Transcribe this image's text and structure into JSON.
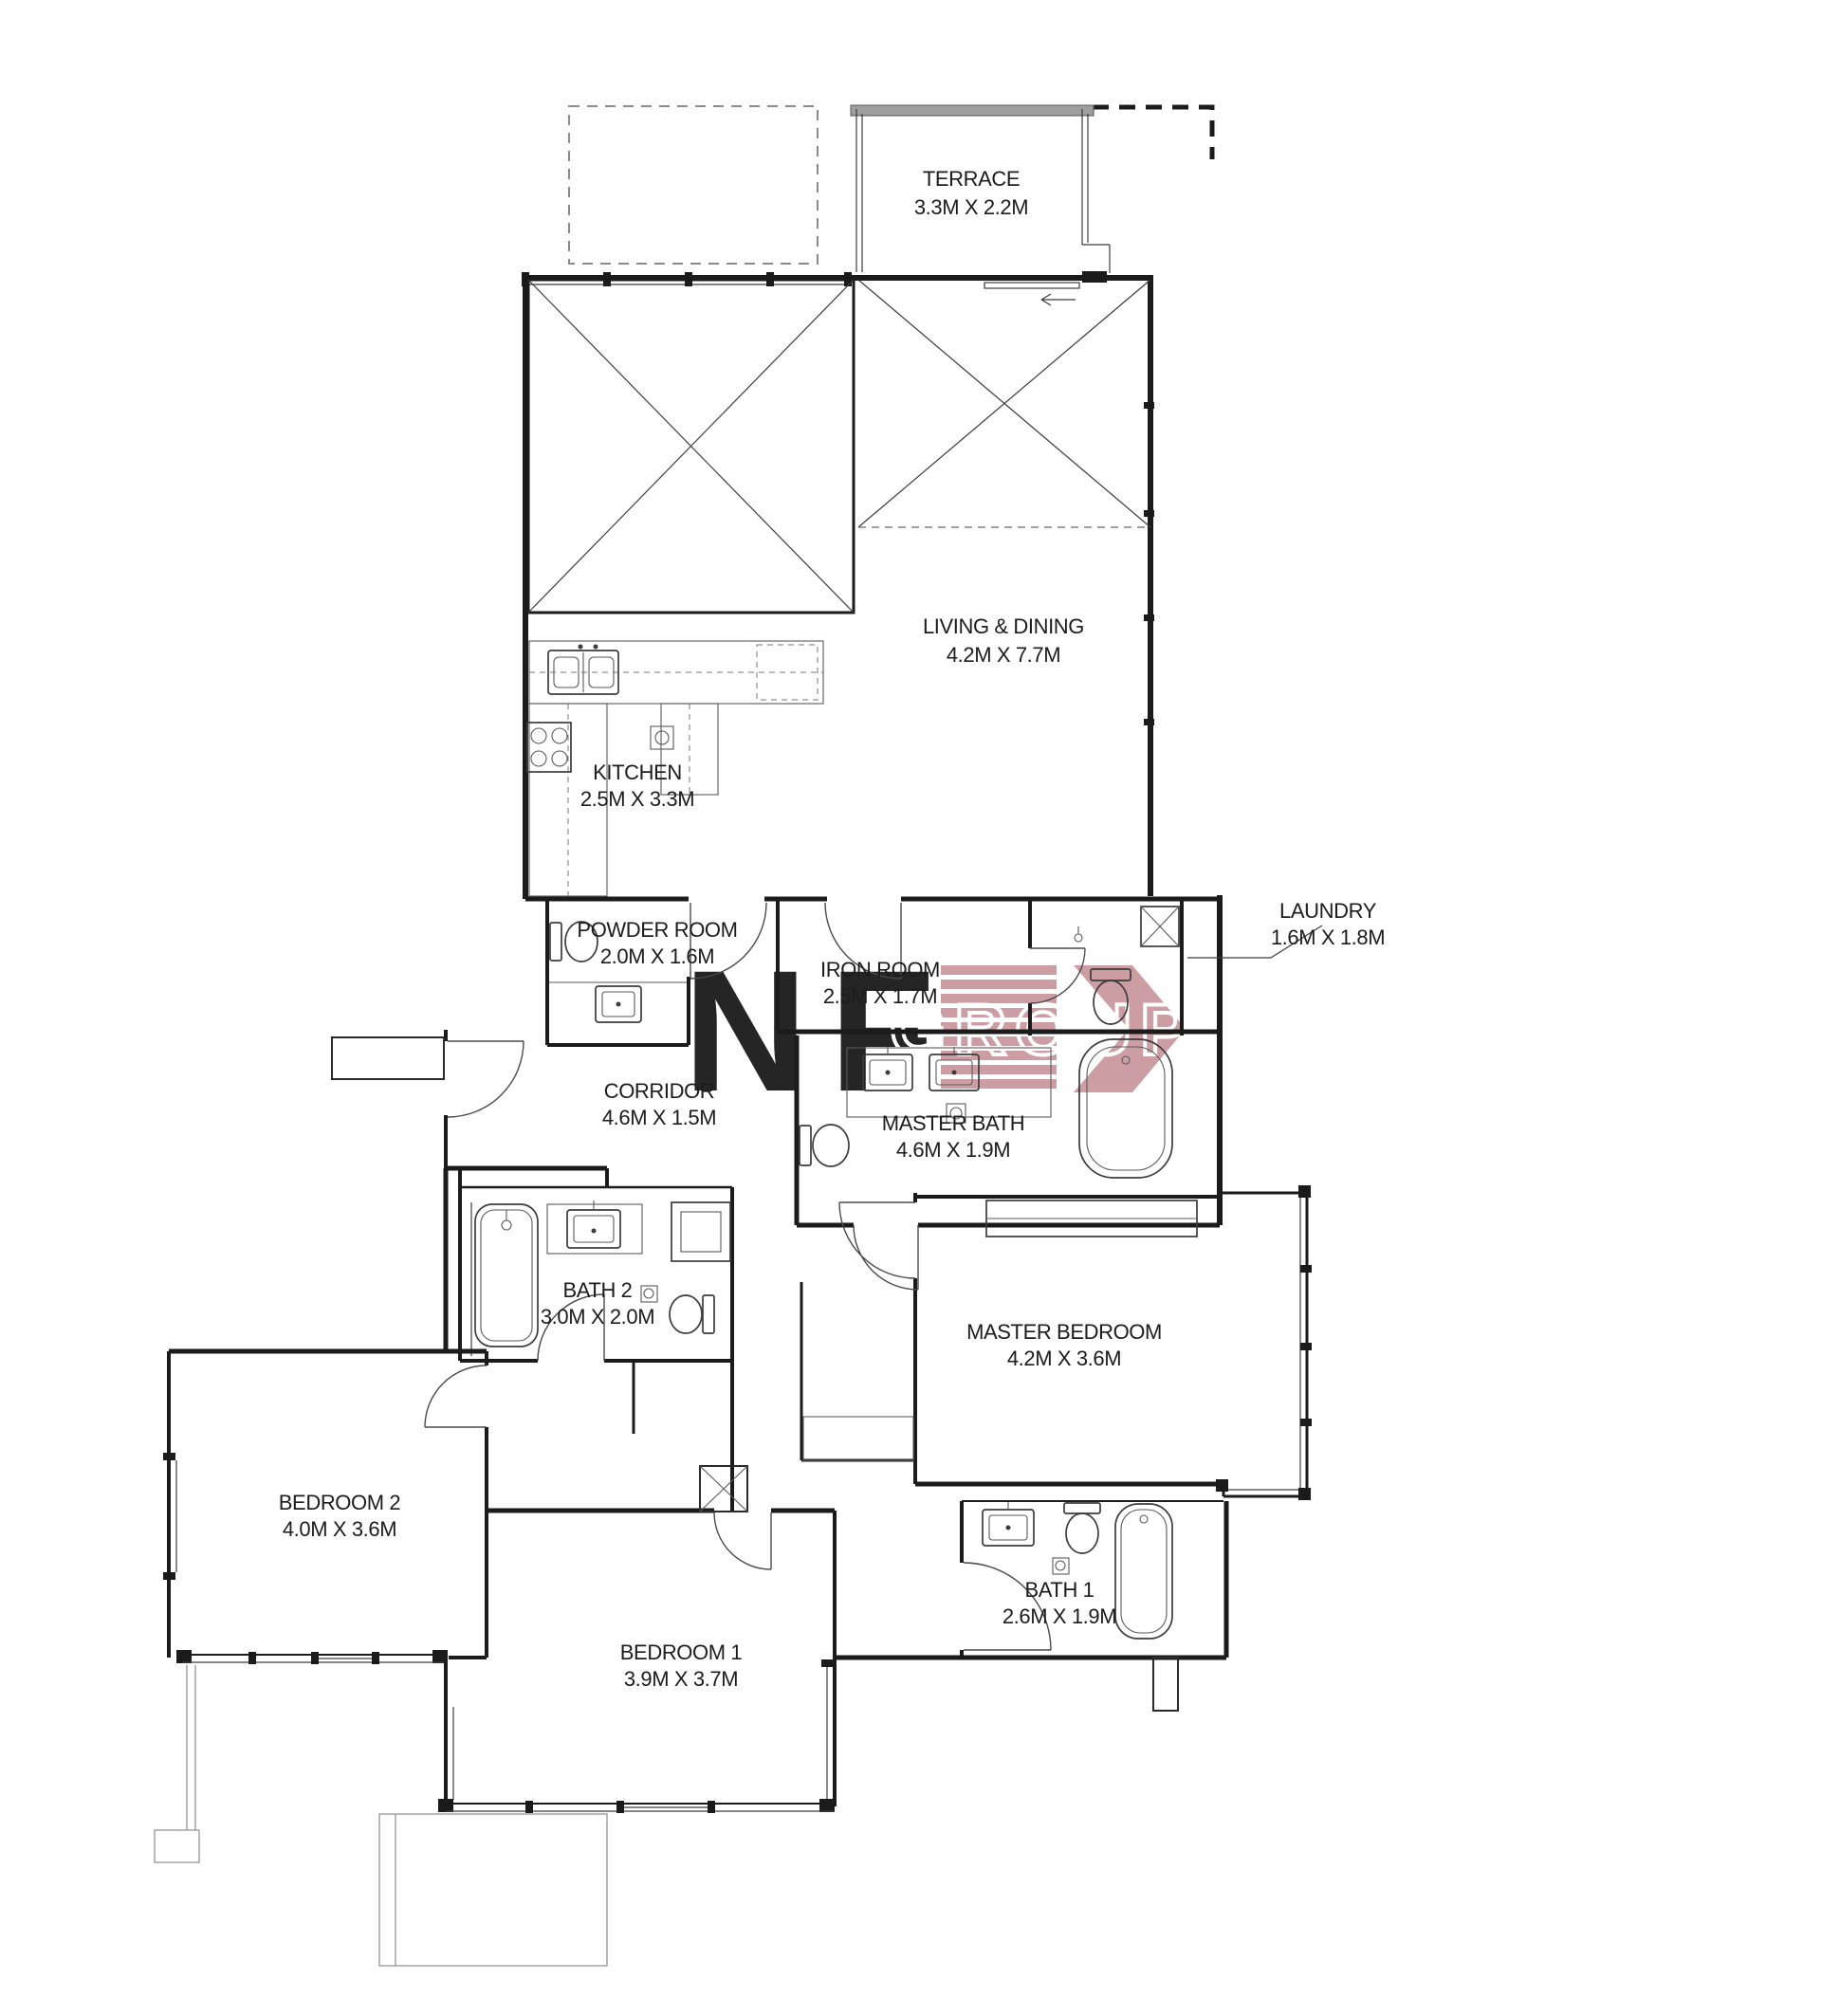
{
  "page": {
    "background": "#ffffff",
    "type": "apartment floor plan drawing"
  },
  "colors": {
    "wall": "#1b1b1b",
    "watermark_pink": "#c58d95",
    "terrace_wall_gray": "#9f9f9f",
    "label_text": "#1c1c1c"
  },
  "watermark": {
    "letter_n": "N",
    "letter_f": "F",
    "wordmark": "GROUP",
    "color": "#c58d95"
  },
  "rooms": {
    "terrace": {
      "name": "TERRACE",
      "dims": "3.3M X 2.2M"
    },
    "living_dining": {
      "name": "LIVING & DINING",
      "dims": "4.2M X 7.7M"
    },
    "kitchen": {
      "name": "KITCHEN",
      "dims": "2.5M X 3.3M"
    },
    "powder_room": {
      "name": "POWDER ROOM",
      "dims": "2.0M X 1.6M"
    },
    "iron_room": {
      "name": "IRON ROOM",
      "dims": "2.5M X 1.7M"
    },
    "laundry": {
      "name": "LAUNDRY",
      "dims": "1.6M X 1.8M"
    },
    "corridor": {
      "name": "CORRIDOR",
      "dims": "4.6M X 1.5M"
    },
    "master_bath": {
      "name": "MASTER BATH",
      "dims": "4.6M X 1.9M"
    },
    "bath_2": {
      "name": "BATH 2",
      "dims": "3.0M X 2.0M"
    },
    "master_bedroom": {
      "name": "MASTER BEDROOM",
      "dims": "4.2M X 3.6M"
    },
    "bedroom_2": {
      "name": "BEDROOM 2",
      "dims": "4.0M X 3.6M"
    },
    "bedroom_1": {
      "name": "BEDROOM 1",
      "dims": "3.9M X 3.7M"
    },
    "bath_1": {
      "name": "BATH 1",
      "dims": "2.6M X 1.9M"
    }
  }
}
